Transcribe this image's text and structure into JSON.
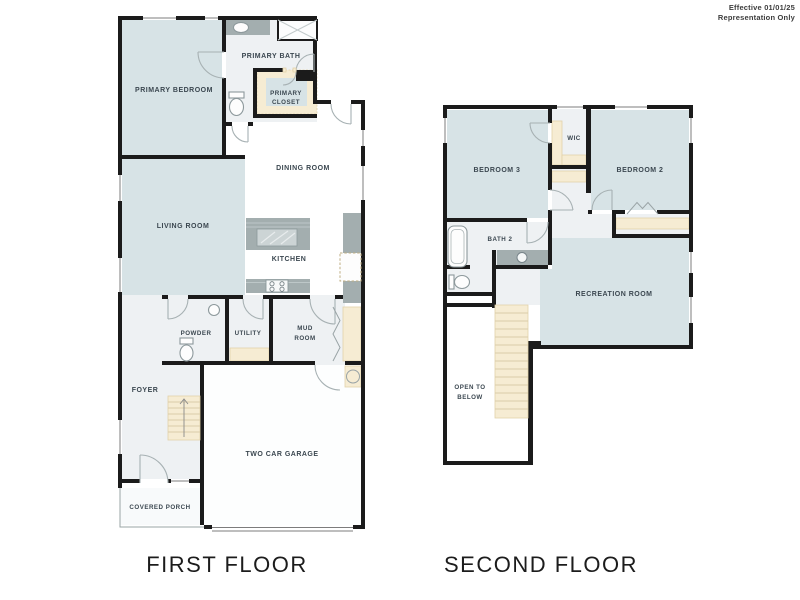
{
  "header": {
    "line1": "Effective 01/01/25",
    "line2": "Representation Only"
  },
  "captions": {
    "first": "FIRST FLOOR",
    "second": "SECOND FLOOR"
  },
  "first_floor": {
    "rooms": {
      "primary_bedroom": "PRIMARY BEDROOM",
      "primary_bath": "PRIMARY BATH",
      "primary_closet_line1": "PRIMARY",
      "primary_closet_line2": "CLOSET",
      "dining_room": "DINING ROOM",
      "living_room": "LIVING ROOM",
      "kitchen": "KITCHEN",
      "powder": "POWDER",
      "utility": "UTILITY",
      "mud_room_line1": "MUD",
      "mud_room_line2": "ROOM",
      "foyer": "FOYER",
      "garage": "TWO CAR GARAGE",
      "covered_porch": "COVERED PORCH"
    }
  },
  "second_floor": {
    "rooms": {
      "bedroom_3": "BEDROOM 3",
      "wic": "WIC",
      "bedroom_2": "BEDROOM 2",
      "bath_2": "BATH 2",
      "recreation_room": "RECREATION ROOM",
      "open_to_below_line1": "OPEN TO",
      "open_to_below_line2": "BELOW"
    }
  },
  "colors": {
    "wall": "#1b1b1b",
    "room_blue": "#d7e3e6",
    "room_light": "#eef1f3",
    "shelf_tan": "#f6ecd3",
    "counter_gray": "#a3aeaf",
    "label_text": "#3b4750"
  }
}
